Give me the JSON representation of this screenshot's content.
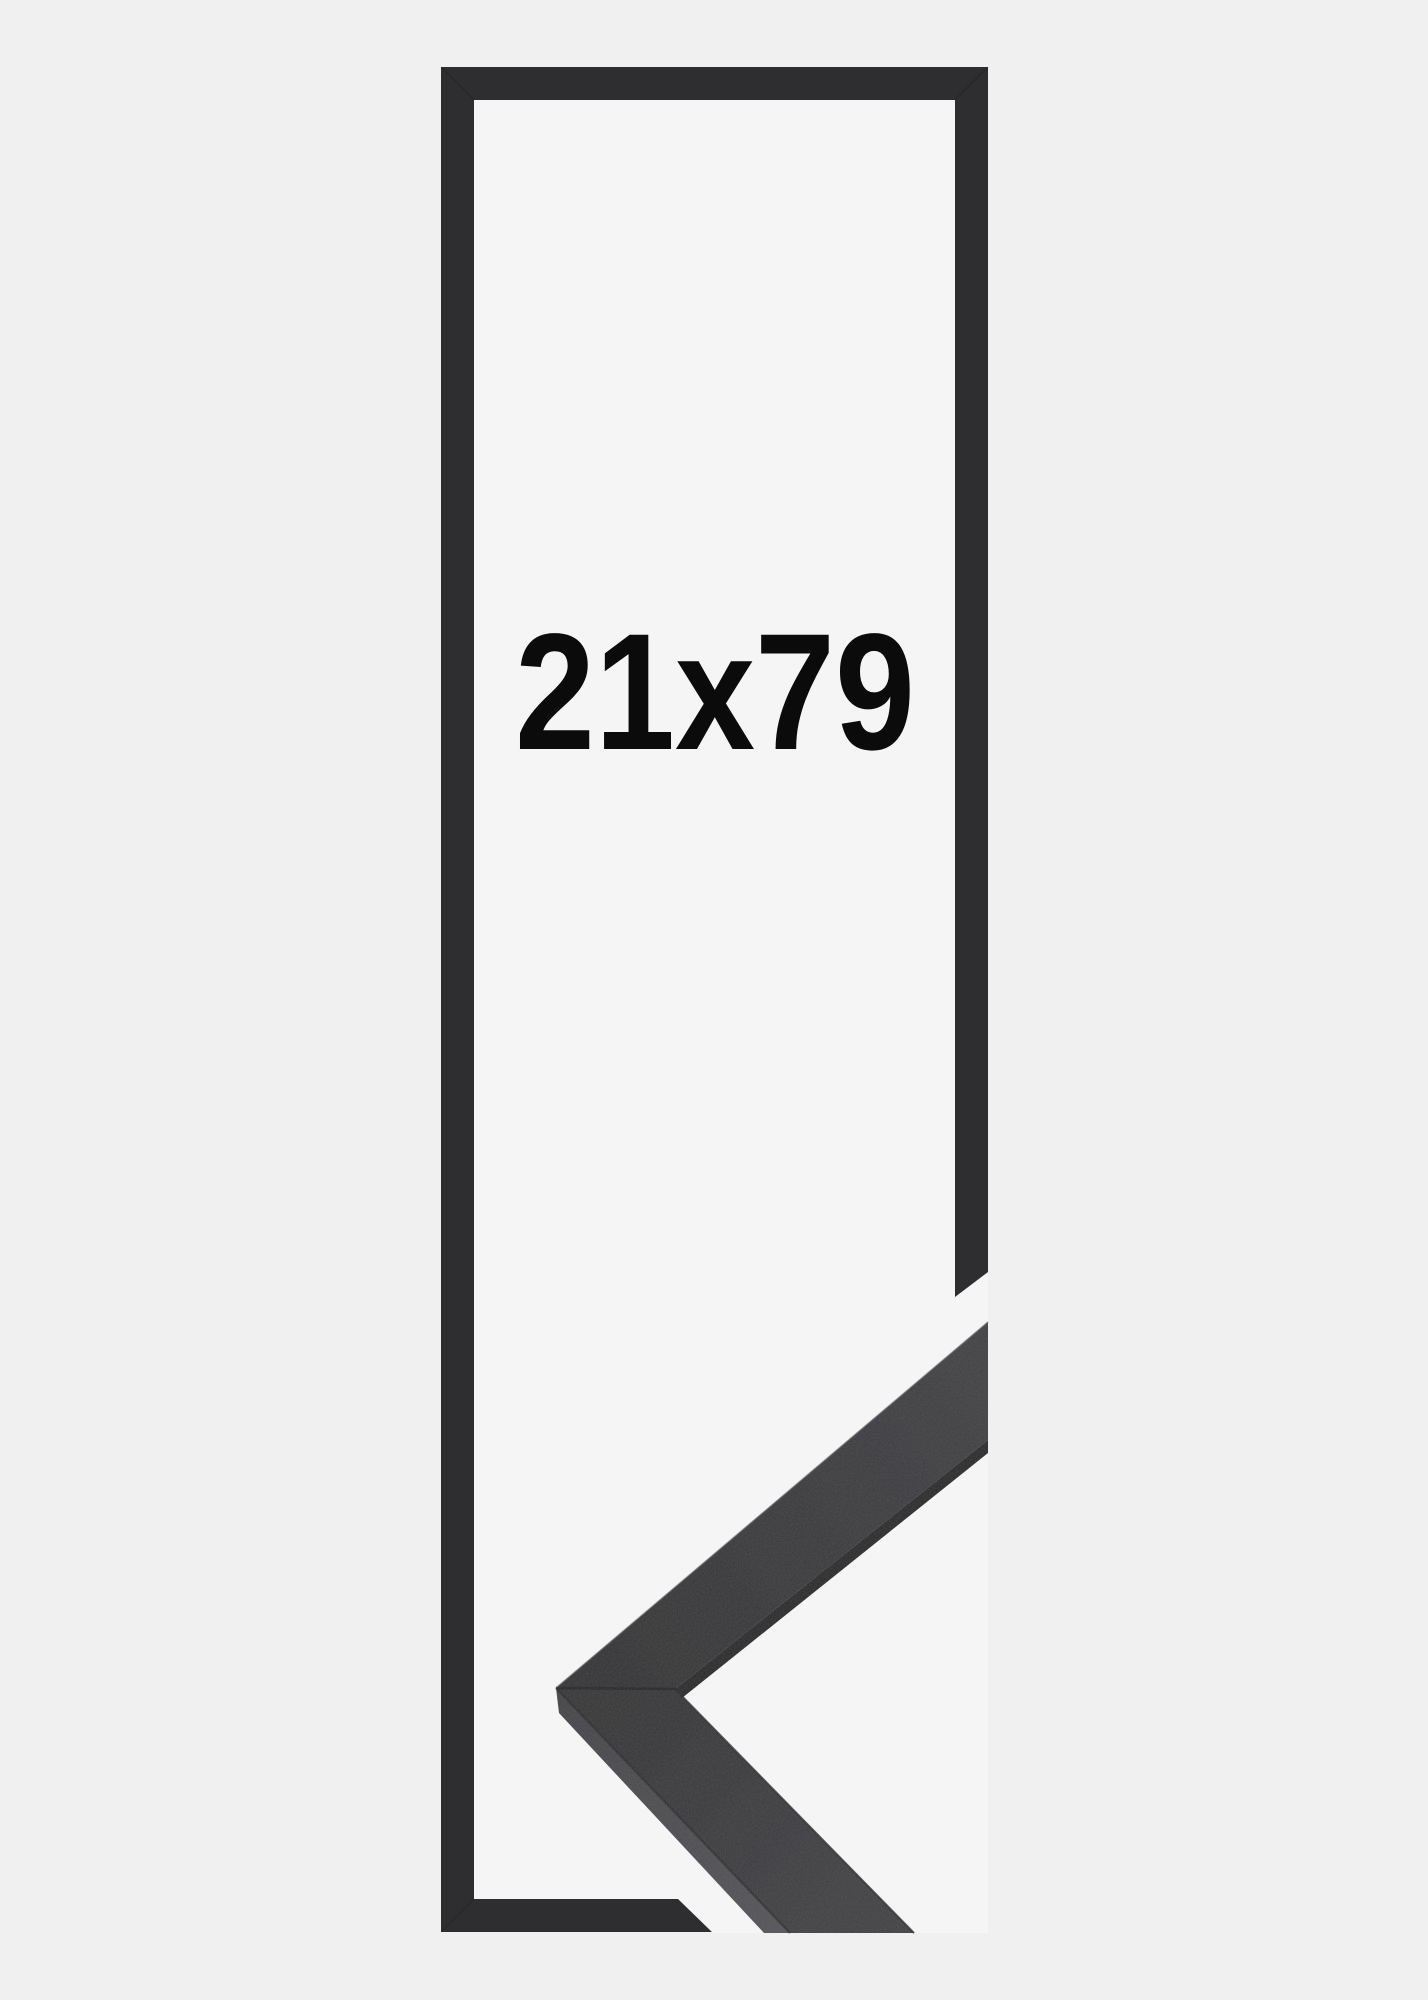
{
  "image": {
    "kind": "frame-size-mockup",
    "size_label": "21x79"
  },
  "icons": {
    "frame_outline": "picture-frame-front-outline",
    "corner_sample": "frame-moulding-corner-3d"
  },
  "colors": {
    "background": "#f0f0f1",
    "photo_white": "#f5f5f5",
    "frame_dark": "#2e2e30",
    "corner_shadow_edge": "#222224",
    "label_text": "#0b0b0b"
  }
}
